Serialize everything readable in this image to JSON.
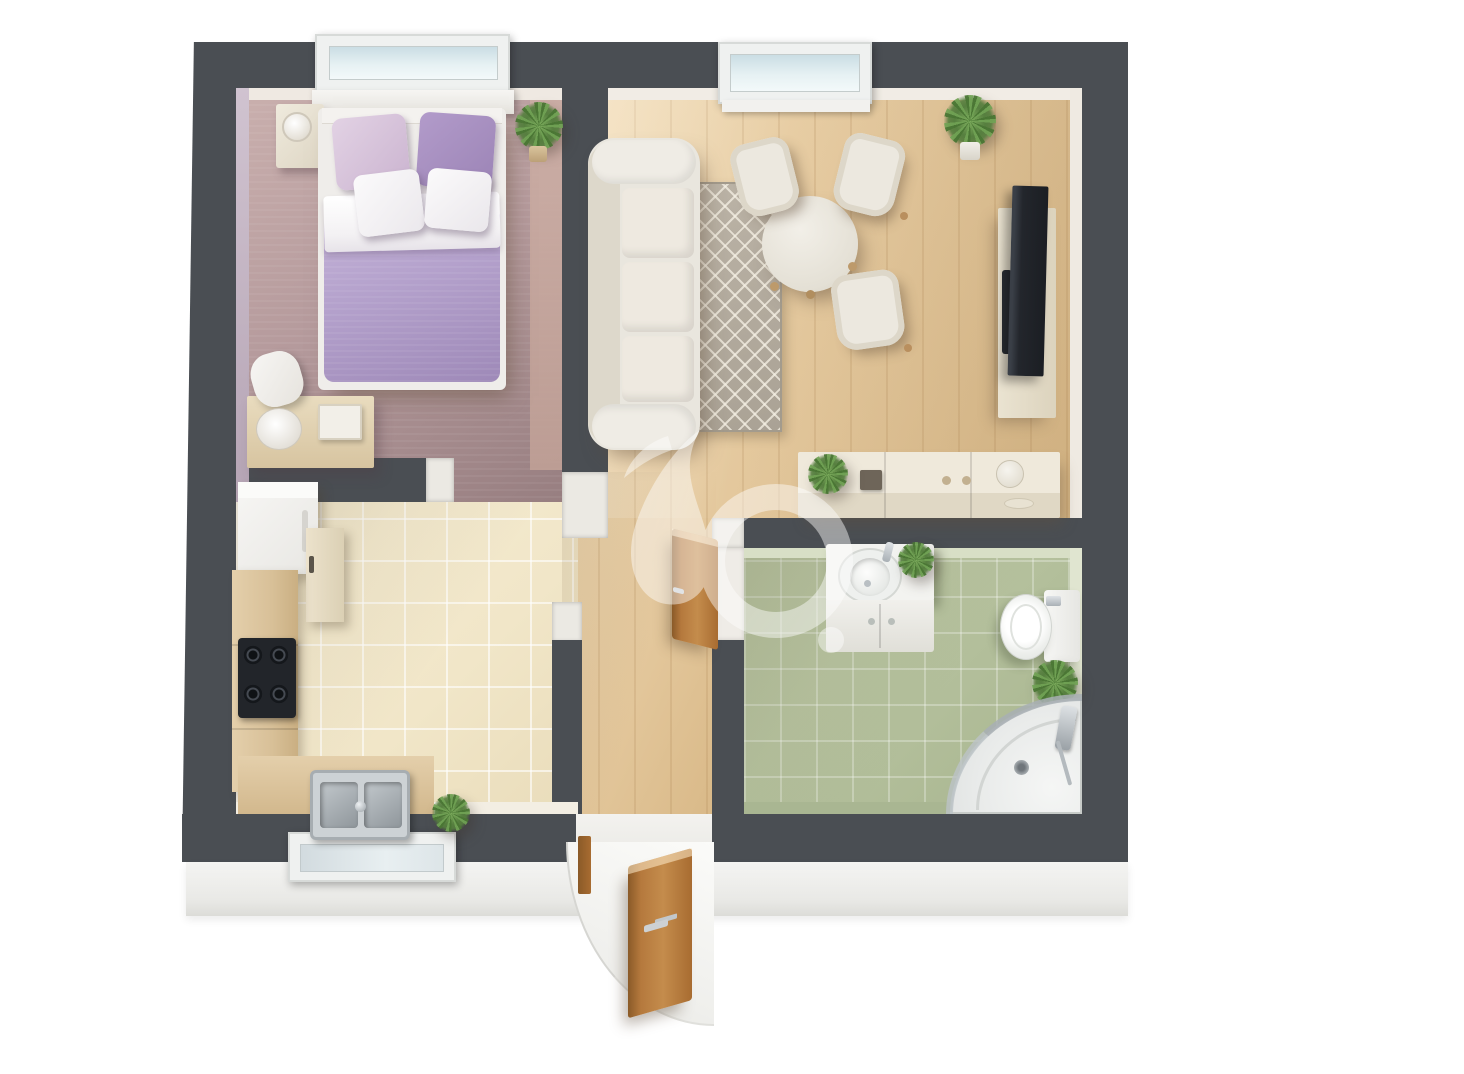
{
  "scene": {
    "kind": "3D rendered floor plan of a one-bedroom apartment, top-down view on white background",
    "background_color": "#ffffff",
    "walls_color": "#4a4e53",
    "watermark": {
      "description": "large translucent white logo glyph (leaf shape, ring and dot) over the hallway center",
      "color": "#ffffff",
      "opacity": 0.45
    }
  },
  "palette": {
    "wall_dark": "#4a4e53",
    "wall_face_light": "#efeae3",
    "bedroom_accent_wall": "#c8b8c8",
    "bedroom_carpet": "#b49a9c",
    "wood_floor": "#e3c89e",
    "kitchen_tile": "#f3ead1",
    "bathroom_tile": "#b5c09c",
    "bedding_lavender": "#b2a0ca",
    "pillow_pink": "#d6c3dc",
    "pillow_purple": "#a78fc0",
    "upholstery_cream": "#ebe8e0",
    "rug_gray": "#b3aba0",
    "door_wood": "#b0763a",
    "appliance_dark": "#23262b",
    "chrome": "#c3c7ca",
    "plant_green": "#5f8c47",
    "exterior_band": "#efefec",
    "glass_blue": "#cfe2e8"
  },
  "rooms": {
    "bedroom": {
      "label": "Bedroom",
      "floor": "mauve carpet",
      "items": [
        "double bed with lavender duvet and white fold",
        "lavender-pink pillow",
        "purple pillow",
        "two white pillows",
        "white bed frame with headboard shelf",
        "nightstand with alarm clock",
        "side desk with table lamp and book",
        "potted plant",
        "window above bed"
      ]
    },
    "living_room": {
      "label": "Living room",
      "floor": "light wood planks",
      "items": [
        "three-seat cream sofa",
        "gray diamond-pattern rug",
        "round dining table",
        "three cream chairs",
        "flat TV leaning on low media board",
        "soundbar",
        "sideboard with plant, small box, knobs and jug",
        "potted palm in corner",
        "window"
      ]
    },
    "kitchen": {
      "label": "Kitchen",
      "floor": "beige ceramic tiles",
      "items": [
        "refrigerator",
        "tall cabinet",
        "wood worktop along left wall",
        "black cooktop with four burners",
        "double-bowl stainless sink with faucet",
        "small potted plant",
        "window below sink"
      ]
    },
    "bathroom": {
      "label": "Bathroom",
      "floor": "sage green tiles",
      "items": [
        "vanity cabinet with round washbasin and faucet",
        "plant on vanity",
        "toilet with cistern and chrome flush",
        "floor plant",
        "corner shower with curved glass, round tray and drain",
        "wall-mounted shower fittings"
      ]
    },
    "hallway": {
      "label": "Hallway",
      "floor": "light wood planks",
      "items": [
        "open wooden bathroom door",
        "open wooden entrance door with white swing arc"
      ]
    },
    "entrance": {
      "label": "Entrance"
    }
  },
  "openings": {
    "windows": [
      {
        "room": "bedroom",
        "wall": "top"
      },
      {
        "room": "living_room",
        "wall": "top"
      },
      {
        "room": "kitchen",
        "wall": "bottom"
      }
    ],
    "doors": [
      {
        "name": "entrance door",
        "material": "wood",
        "state": "open outward"
      },
      {
        "name": "bathroom door",
        "material": "wood",
        "state": "open into hallway"
      }
    ],
    "doorways_without_door": [
      {
        "between": [
          "bedroom",
          "hallway"
        ]
      },
      {
        "between": [
          "kitchen",
          "hallway"
        ]
      },
      {
        "between": [
          "living_room",
          "hallway"
        ]
      }
    ]
  },
  "counts": {
    "rooms": 4,
    "windows": 3,
    "wood_doors": 2,
    "plants": 6,
    "dining_chairs": 3,
    "stove_burners": 4,
    "bed_pillows": 4
  }
}
